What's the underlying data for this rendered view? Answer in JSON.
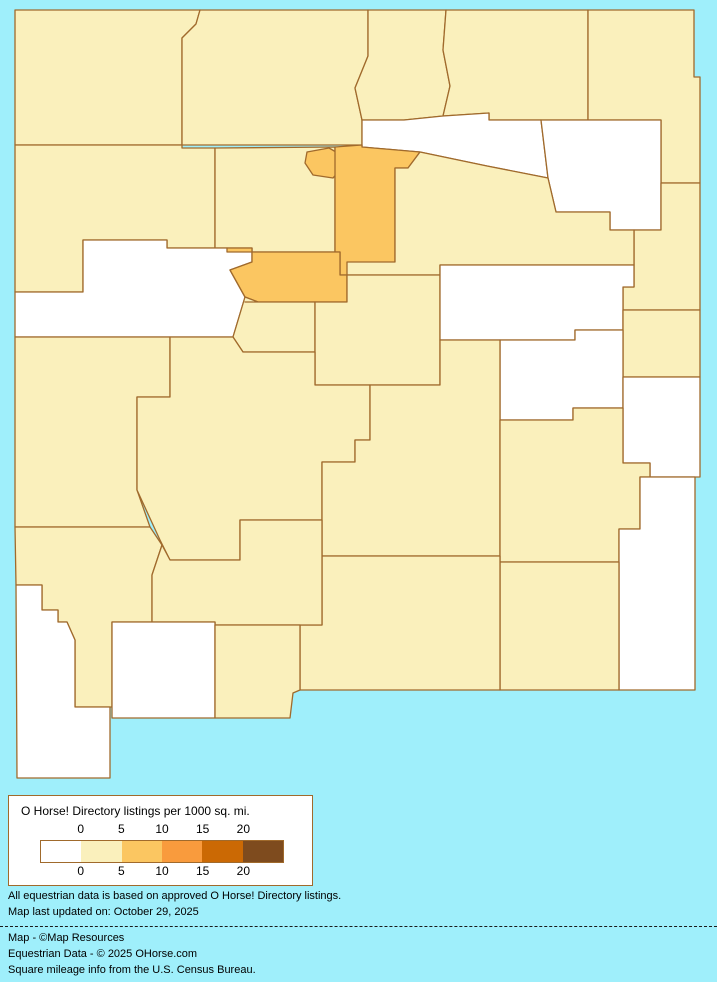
{
  "map": {
    "region": "New Mexico counties choropleth",
    "background_color": "#9FEFFB",
    "border_color": "#A06A2C",
    "category_colors": {
      "zero": "#FFFFFF",
      "low": "#FAF0BC",
      "mid": "#FBC661"
    },
    "counties": [
      {
        "id": "san-juan",
        "name": "San Juan",
        "category": "low"
      },
      {
        "id": "rio-arriba",
        "name": "Rio Arriba",
        "category": "low"
      },
      {
        "id": "taos",
        "name": "Taos",
        "category": "low"
      },
      {
        "id": "colfax",
        "name": "Colfax",
        "category": "low"
      },
      {
        "id": "union",
        "name": "Union",
        "category": "low"
      },
      {
        "id": "mora",
        "name": "Mora",
        "category": "zero"
      },
      {
        "id": "harding",
        "name": "Harding",
        "category": "zero"
      },
      {
        "id": "quay",
        "name": "Quay",
        "category": "low"
      },
      {
        "id": "mckinley",
        "name": "McKinley",
        "category": "low"
      },
      {
        "id": "sandoval",
        "name": "Sandoval",
        "category": "low"
      },
      {
        "id": "los-alamos",
        "name": "Los Alamos",
        "category": "mid"
      },
      {
        "id": "santa-fe",
        "name": "Santa Fe",
        "category": "mid"
      },
      {
        "id": "san-miguel",
        "name": "San Miguel",
        "category": "low"
      },
      {
        "id": "cibola",
        "name": "Cibola",
        "category": "zero"
      },
      {
        "id": "bernalillo",
        "name": "Bernalillo",
        "category": "mid"
      },
      {
        "id": "valencia",
        "name": "Valencia",
        "category": "low"
      },
      {
        "id": "torrance",
        "name": "Torrance",
        "category": "low"
      },
      {
        "id": "guadalupe",
        "name": "Guadalupe",
        "category": "zero"
      },
      {
        "id": "curry",
        "name": "Curry",
        "category": "low"
      },
      {
        "id": "de-baca",
        "name": "De Baca",
        "category": "zero"
      },
      {
        "id": "roosevelt",
        "name": "Roosevelt",
        "category": "zero"
      },
      {
        "id": "catron",
        "name": "Catron",
        "category": "low"
      },
      {
        "id": "socorro",
        "name": "Socorro",
        "category": "low"
      },
      {
        "id": "lincoln",
        "name": "Lincoln",
        "category": "low"
      },
      {
        "id": "chaves",
        "name": "Chaves",
        "category": "low"
      },
      {
        "id": "lea",
        "name": "Lea",
        "category": "zero"
      },
      {
        "id": "eddy",
        "name": "Eddy",
        "category": "low"
      },
      {
        "id": "otero",
        "name": "Otero",
        "category": "low"
      },
      {
        "id": "grant",
        "name": "Grant",
        "category": "low"
      },
      {
        "id": "sierra",
        "name": "Sierra",
        "category": "low"
      },
      {
        "id": "hidalgo",
        "name": "Hidalgo",
        "category": "zero"
      },
      {
        "id": "luna",
        "name": "Luna",
        "category": "zero"
      },
      {
        "id": "dona-ana",
        "name": "Dona Ana",
        "category": "low"
      }
    ]
  },
  "legend": {
    "title": "O Horse! Directory listings per 1000 sq. mi.",
    "ticks": [
      "0",
      "5",
      "10",
      "15",
      "20"
    ],
    "swatches": [
      "#FFFFFF",
      "#FAF0BC",
      "#FBC661",
      "#F99B3D",
      "#CB6904",
      "#7E4B1E"
    ],
    "box_border_color": "#A06A2C"
  },
  "notes": {
    "line1": "All equestrian data is based on approved O Horse! Directory listings.",
    "line2": "Map last updated on:  October 29, 2025"
  },
  "credits": {
    "line1": "Map - ©Map Resources",
    "line2": "Equestrian Data - © 2025 OHorse.com",
    "line3": "Square mileage info from the U.S. Census Bureau."
  }
}
